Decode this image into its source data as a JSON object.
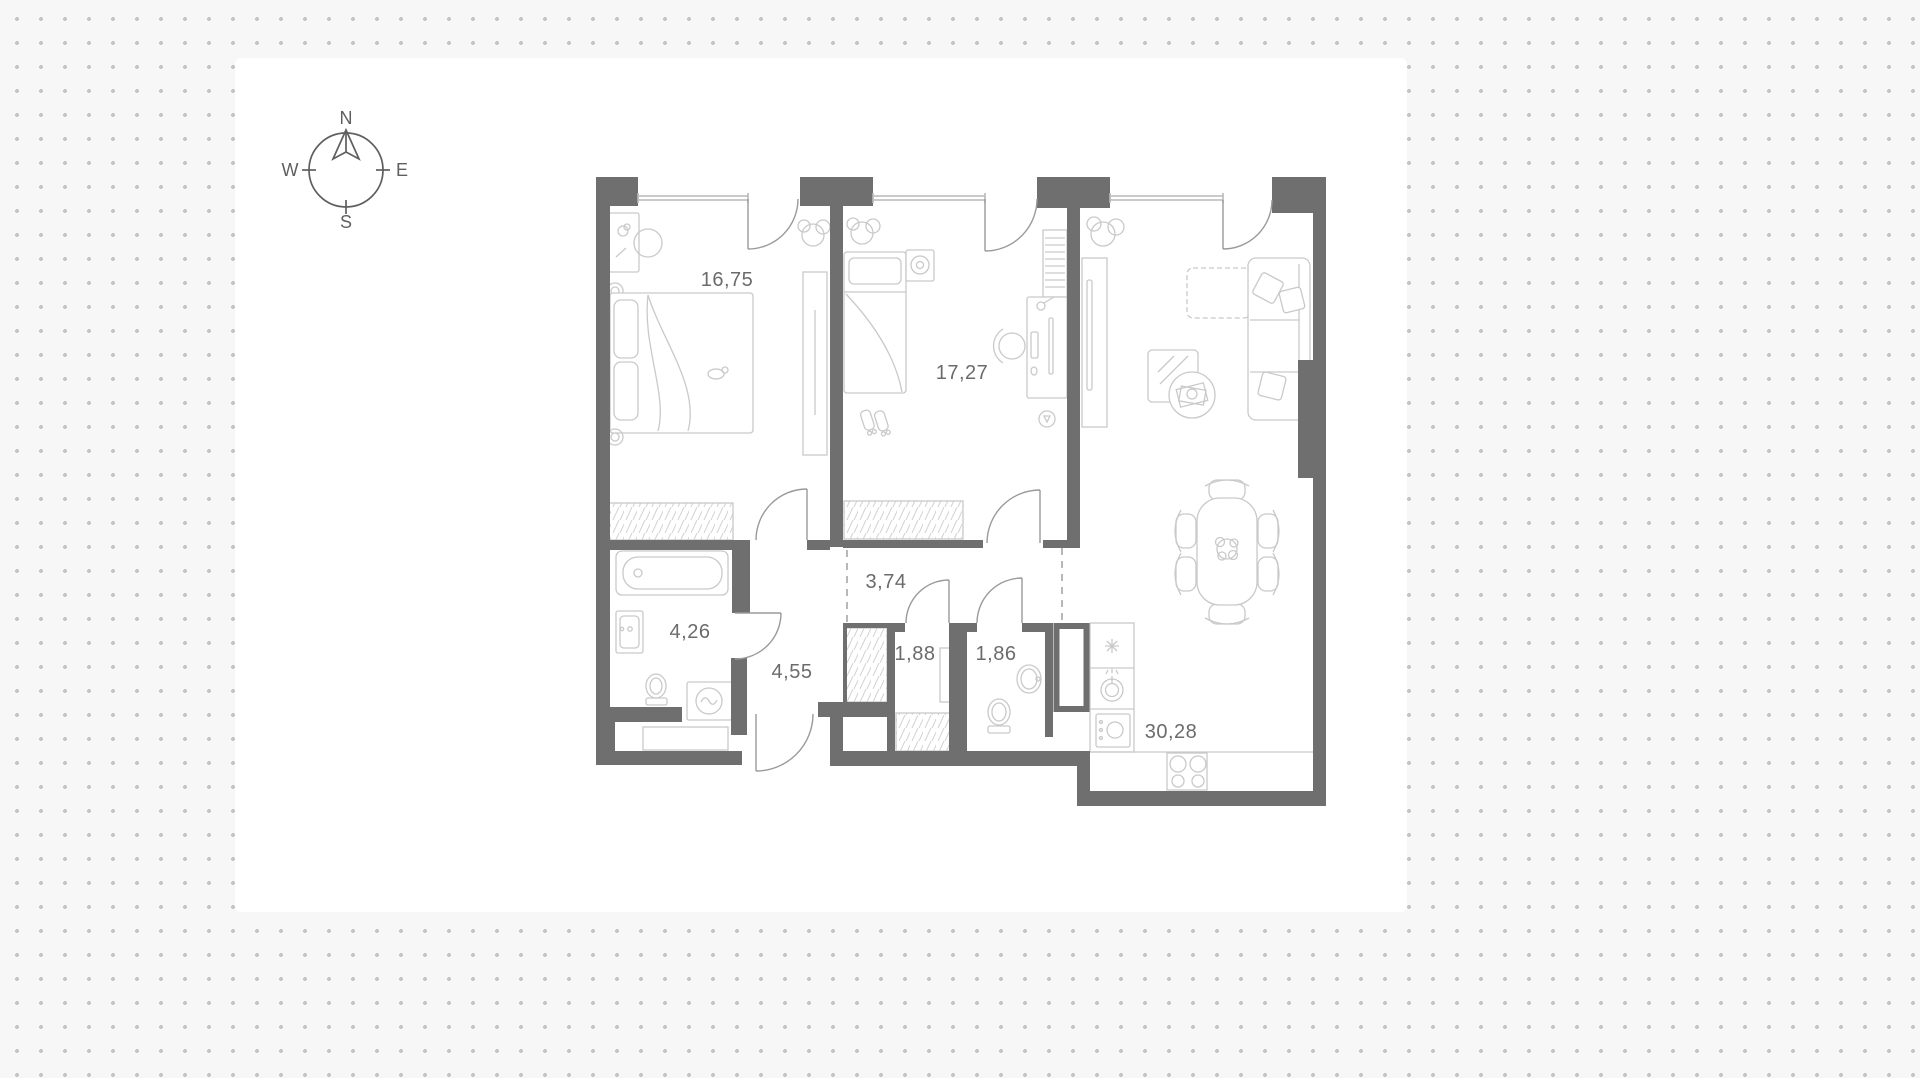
{
  "compass": {
    "n": "N",
    "e": "E",
    "s": "S",
    "w": "W"
  },
  "rooms": [
    {
      "name": "bedroom-1",
      "area": "16,75"
    },
    {
      "name": "bedroom-2",
      "area": "17,27"
    },
    {
      "name": "corridor",
      "area": "3,74"
    },
    {
      "name": "bathroom",
      "area": "4,26"
    },
    {
      "name": "hallway",
      "area": "4,55"
    },
    {
      "name": "storage",
      "area": "1,88"
    },
    {
      "name": "wc",
      "area": "1,86"
    },
    {
      "name": "kitchen-living-room",
      "area": "30,28"
    }
  ],
  "colors": {
    "background": "#f7f7f7",
    "dot_grid": "#c5c5c5",
    "plan_canvas": "#ffffff",
    "walls": "#6f6f6f",
    "furniture_lines": "#c9c9c9",
    "labels": "#6b6b6b"
  }
}
